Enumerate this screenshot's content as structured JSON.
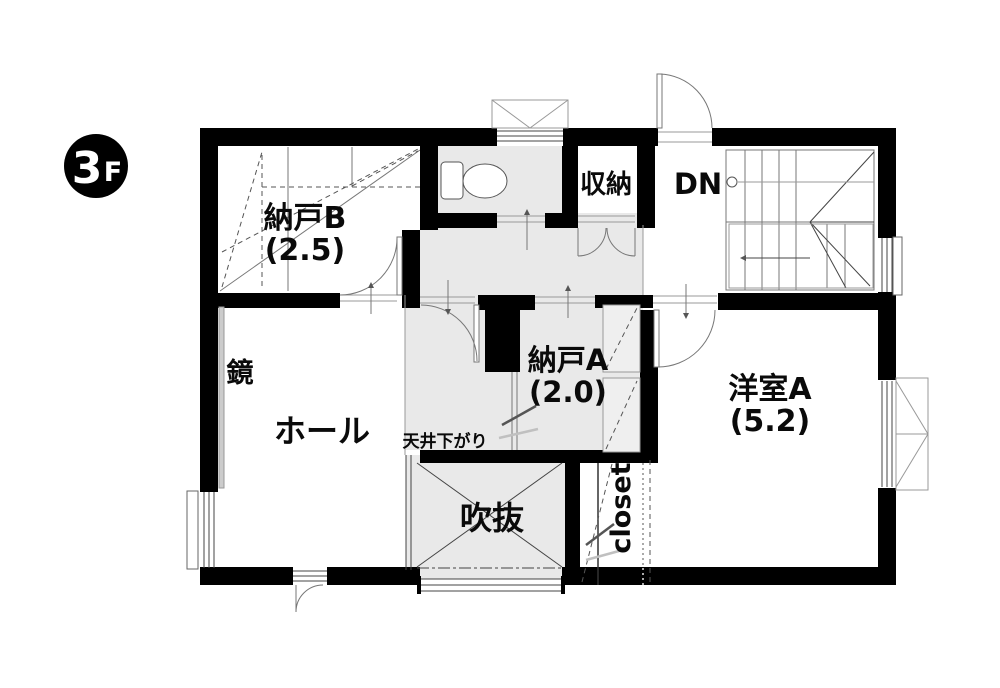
{
  "floor_badge": {
    "digit": "3",
    "letter": "F"
  },
  "labels": {
    "nando_b_name": "納戸B",
    "nando_b_size": "(2.5)",
    "shuno": "収納",
    "stairs_dn": "DN",
    "mirror": "鏡",
    "hall": "ホール",
    "nando_a_name": "納戸A",
    "nando_a_size": "(2.0)",
    "yoshitsu_a_name": "洋室A",
    "yoshitsu_a_size": "(5.2)",
    "ceiling_drop": "天井下がり",
    "fukinuke": "吹抜",
    "closet": "closet"
  },
  "colors": {
    "wall": "#000000",
    "floor_gray": "#e9e9e9",
    "line_gray": "#777777",
    "badge_bg": "#000000",
    "badge_text": "#ffffff"
  }
}
